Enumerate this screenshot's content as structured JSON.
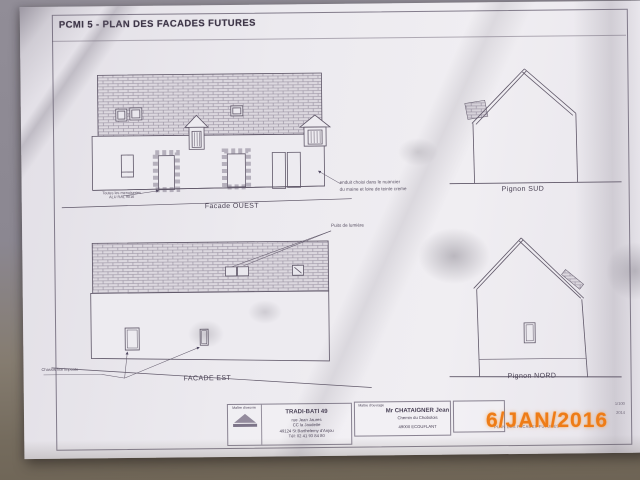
{
  "sheet": {
    "title": "PCMI 5 - PLAN DES FACADES FUTURES"
  },
  "drawings": {
    "facade_ouest": {
      "label": "Facade OUEST",
      "note_menuiseries": "Toutes les menuiseries\nALU RAL 9016",
      "note_enduit": "enduit choisi dans le nuancier\ndu maine et loire de teinte creme"
    },
    "pignon_sud": {
      "label": "Pignon SUD"
    },
    "facade_est": {
      "label": "FACADE EST",
      "note_puits": "Puits de lumière",
      "note_chassis": "Chassis fixe imposte"
    },
    "pignon_nord": {
      "label": "Pignon NORD"
    }
  },
  "title_block": {
    "maitre_oeuvre_label": "Maître d'oeuvre",
    "maitre_oeuvre": {
      "name": "TRADI-BATI 49",
      "line1": "rue Jean Jaures",
      "line2": "CC la Jaudette",
      "line3": "49124 St Barthelemy d'Anjou",
      "line4": "Tél: 02 41 93 84 80"
    },
    "maitre_ouvrage_label": "Maître d'ouvrage",
    "maitre_ouvrage": {
      "name": "Mr CHATAIGNER Jean",
      "line1": "Chemin du Chobolois",
      "line2": "49000 ECOUFLANT"
    },
    "scale": "1/100",
    "year": "2014",
    "doc_title_footer": "PLAN DES FACADES FUTURES"
  },
  "stamp": {
    "date": "6/JAN/2016",
    "color": "#ee7c17"
  }
}
